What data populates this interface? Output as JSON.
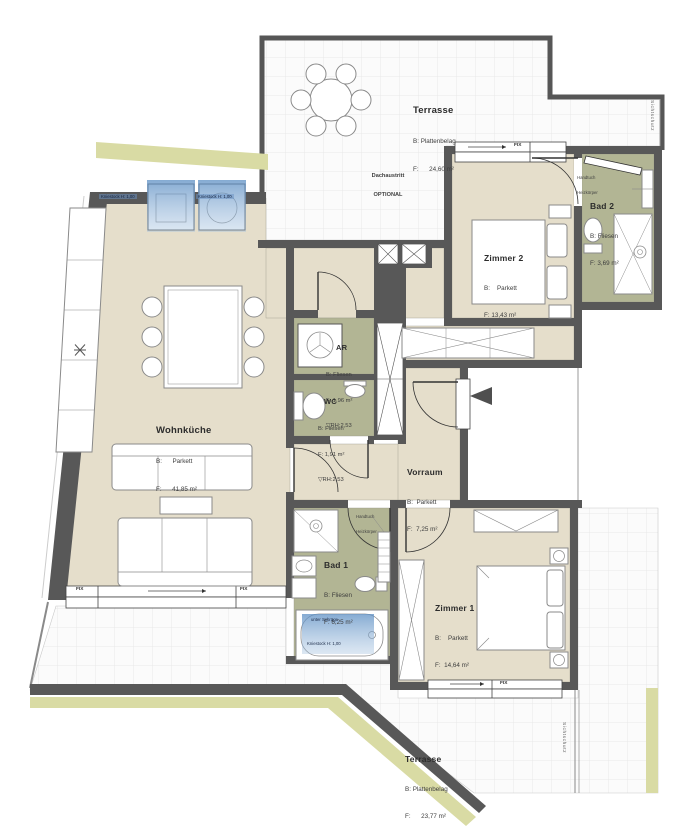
{
  "plan_title": "Wohnung Grundriss",
  "rooms": {
    "terrasse_top": {
      "name": "Terrasse",
      "floor": "B: Plattenbelag",
      "area": "F:      24,60 m²"
    },
    "zimmer2": {
      "name": "Zimmer 2",
      "floor": "B:    Parkett",
      "area": "F: 13,43 m²"
    },
    "bad2": {
      "name": "Bad 2",
      "floor": "B: Fliesen",
      "area": "F: 3,69 m²"
    },
    "ar": {
      "name": "AR",
      "floor": "B: Fliesen",
      "area": "F: 1,96 m²",
      "height": "▽RH:2,53"
    },
    "wc": {
      "name": "WC",
      "floor": "B: Fliesen",
      "area": "F: 1,91 m²",
      "height": "▽RH:2,53"
    },
    "wohnkueche": {
      "name": "Wohnküche",
      "floor": "B:      Parkett",
      "area": "F:      41,85 m²"
    },
    "vorraum": {
      "name": "Vorraum",
      "floor": "B:  Parkett",
      "area": "F:  7,25 m²"
    },
    "bad1": {
      "name": "Bad 1",
      "floor": "B: Fliesen",
      "area": "F: 6,25 m²"
    },
    "zimmer1": {
      "name": "Zimmer 1",
      "floor": "B:    Parkett",
      "area": "F:  14,64 m²"
    },
    "terrasse_bottom": {
      "name": "Terrasse",
      "floor": "B: Plattenbelag",
      "area": "F:      23,77 m²"
    }
  },
  "annotations": {
    "roof_access_line1": "Dachaustritt",
    "roof_access_line2": "OPTIONAL",
    "towel_radiator_line1": "Handtuch",
    "towel_radiator_line2": "Heizkörper",
    "window_fixed": "FIX",
    "privacy_screen": "Sichtschutz",
    "knee_wall_note": "Kniestock H: 1,00",
    "tub_note": "unter Schräge"
  },
  "colors": {
    "wall": "#585858",
    "parquet_room": "#e5decb",
    "tile_room": "#b2b594",
    "exterior_strip": "#d9dba4",
    "highlight_blue": "#6f9cc9"
  }
}
